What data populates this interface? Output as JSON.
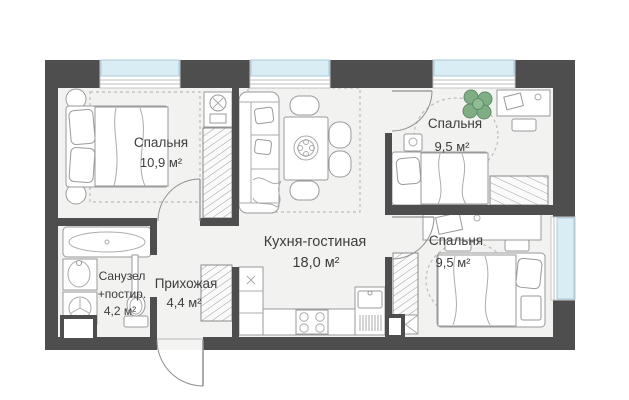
{
  "plan": {
    "type": "apartment-floor-plan",
    "rooms": {
      "bedroom_left": {
        "name": "Спальня",
        "area": "10,9 м²"
      },
      "kitchen_living": {
        "name": "Кухня-гостиная",
        "area": "18,0 м²"
      },
      "bedroom_top_right": {
        "name": "Спальня",
        "area": "9,5 м²"
      },
      "bedroom_bottom_right": {
        "name": "Спальня",
        "area": "9,5 м²"
      },
      "bathroom": {
        "name_line1": "Санузел",
        "name_line2": "+постир.",
        "area": "4,2 м²"
      },
      "hallway": {
        "name": "Прихожая",
        "area": "4,4 м²"
      }
    },
    "colors": {
      "wall": "#4e4e4e",
      "floor": "#f2f2f1",
      "window_glass": "#d9edf5",
      "window_frame": "#a9cbdc",
      "furniture_outline": "#9a9a9a",
      "plant_green": "#7fae85",
      "text": "#3d3d3d"
    }
  }
}
